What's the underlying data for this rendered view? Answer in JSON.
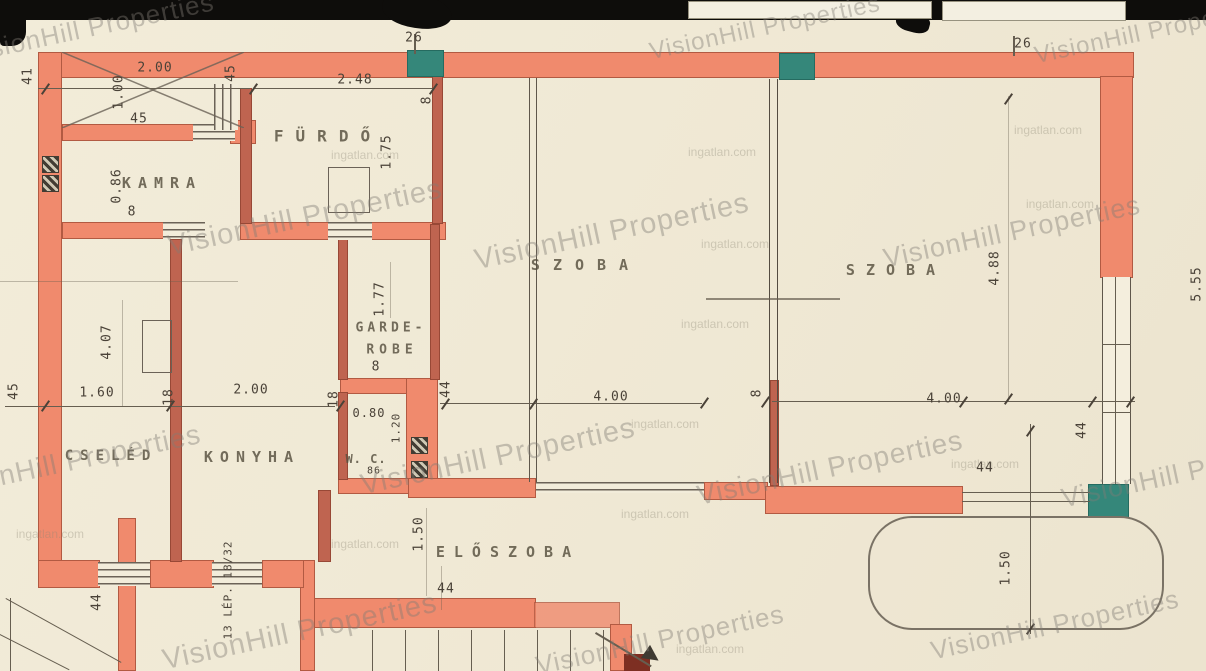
{
  "watermarks": {
    "brand_text": "VisionHill Properties",
    "site_text": "ingatlan.com",
    "brand_marks": [
      {
        "x": 90,
        "y": 28,
        "size": 26
      },
      {
        "x": 765,
        "y": 28,
        "size": 24
      },
      {
        "x": 1150,
        "y": 32,
        "size": 24
      },
      {
        "x": 305,
        "y": 218,
        "size": 29
      },
      {
        "x": 612,
        "y": 232,
        "size": 29
      },
      {
        "x": 1012,
        "y": 232,
        "size": 27
      },
      {
        "x": 68,
        "y": 462,
        "size": 28
      },
      {
        "x": 498,
        "y": 457,
        "size": 29
      },
      {
        "x": 830,
        "y": 468,
        "size": 28
      },
      {
        "x": 1190,
        "y": 472,
        "size": 27
      },
      {
        "x": 300,
        "y": 632,
        "size": 29
      },
      {
        "x": 660,
        "y": 640,
        "size": 26
      },
      {
        "x": 1055,
        "y": 625,
        "size": 26
      }
    ],
    "site_marks": [
      {
        "x": 722,
        "y": 152
      },
      {
        "x": 735,
        "y": 244
      },
      {
        "x": 715,
        "y": 324
      },
      {
        "x": 665,
        "y": 424
      },
      {
        "x": 655,
        "y": 514
      },
      {
        "x": 365,
        "y": 544
      },
      {
        "x": 50,
        "y": 534
      },
      {
        "x": 985,
        "y": 464
      },
      {
        "x": 1048,
        "y": 130
      },
      {
        "x": 1060,
        "y": 204
      },
      {
        "x": 710,
        "y": 649
      },
      {
        "x": 365,
        "y": 155
      }
    ]
  },
  "floorplan": {
    "room_labels": [
      {
        "text": "FÜRDŐ",
        "x": 328,
        "y": 136,
        "size": 16,
        "ls": 12
      },
      {
        "text": "KAMRA",
        "x": 162,
        "y": 183,
        "size": 15,
        "ls": 7
      },
      {
        "text": "SZOBA",
        "x": 586,
        "y": 265,
        "size": 15,
        "ls": 13
      },
      {
        "text": "SZOBA",
        "x": 896,
        "y": 270,
        "size": 15,
        "ls": 11
      },
      {
        "text": "GARDE-",
        "x": 391,
        "y": 328,
        "size": 13,
        "ls": 4
      },
      {
        "text": "ROBE",
        "x": 392,
        "y": 350,
        "size": 13,
        "ls": 5
      },
      {
        "text": "KONYHA",
        "x": 252,
        "y": 457,
        "size": 15,
        "ls": 7
      },
      {
        "text": "CSELÉD",
        "x": 111,
        "y": 456,
        "size": 14,
        "ls": 7
      },
      {
        "text": "W. C.",
        "x": 366,
        "y": 459,
        "size": 12,
        "ls": 1
      },
      {
        "text": "ELŐSZOBA",
        "x": 508,
        "y": 552,
        "size": 15,
        "ls": 9
      }
    ],
    "dimension_labels": [
      {
        "text": "41",
        "x": 28,
        "y": 76,
        "rot": -90
      },
      {
        "text": "2.00",
        "x": 155,
        "y": 68,
        "rot": 0
      },
      {
        "text": "1.00",
        "x": 119,
        "y": 92,
        "rot": -90
      },
      {
        "text": "45",
        "x": 139,
        "y": 119,
        "rot": 0
      },
      {
        "text": "45",
        "x": 231,
        "y": 73,
        "rot": -90
      },
      {
        "text": "2.48",
        "x": 355,
        "y": 80,
        "rot": 0
      },
      {
        "text": "26",
        "x": 414,
        "y": 38,
        "rot": 0
      },
      {
        "text": "8",
        "x": 427,
        "y": 100,
        "rot": -90
      },
      {
        "text": "1.75",
        "x": 387,
        "y": 152,
        "rot": -90
      },
      {
        "text": "0.86",
        "x": 117,
        "y": 186,
        "rot": -90
      },
      {
        "text": "8",
        "x": 132,
        "y": 212,
        "rot": 0
      },
      {
        "text": "1.77",
        "x": 380,
        "y": 299,
        "rot": -90
      },
      {
        "text": "8",
        "x": 376,
        "y": 367,
        "rot": 0
      },
      {
        "text": "26",
        "x": 1023,
        "y": 44,
        "rot": 0
      },
      {
        "text": "4.88",
        "x": 995,
        "y": 268,
        "rot": -90
      },
      {
        "text": "5.55",
        "x": 1197,
        "y": 284,
        "rot": -90
      },
      {
        "text": "4.07",
        "x": 107,
        "y": 342,
        "rot": -90
      },
      {
        "text": "45",
        "x": 14,
        "y": 391,
        "rot": -90
      },
      {
        "text": "1.60",
        "x": 97,
        "y": 393,
        "rot": 0
      },
      {
        "text": "18",
        "x": 169,
        "y": 397,
        "rot": -90
      },
      {
        "text": "2.00",
        "x": 251,
        "y": 390,
        "rot": 0
      },
      {
        "text": "18",
        "x": 334,
        "y": 399,
        "rot": -90
      },
      {
        "text": "0.80",
        "x": 369,
        "y": 413,
        "rot": 0,
        "size": 12
      },
      {
        "text": "1.20",
        "x": 396,
        "y": 428,
        "rot": -90,
        "size": 11
      },
      {
        "text": "44",
        "x": 446,
        "y": 389,
        "rot": -90
      },
      {
        "text": "4.00",
        "x": 611,
        "y": 397,
        "rot": 0
      },
      {
        "text": "8",
        "x": 757,
        "y": 393,
        "rot": -90
      },
      {
        "text": "4.00",
        "x": 944,
        "y": 399,
        "rot": 0
      },
      {
        "text": "44",
        "x": 1082,
        "y": 430,
        "rot": -90
      },
      {
        "text": "44",
        "x": 985,
        "y": 468,
        "rot": 0
      },
      {
        "text": "1.50",
        "x": 1006,
        "y": 568,
        "rot": -90
      },
      {
        "text": "1.50",
        "x": 419,
        "y": 534,
        "rot": -90
      },
      {
        "text": "44",
        "x": 446,
        "y": 589,
        "rot": 0
      },
      {
        "text": "44",
        "x": 97,
        "y": 602,
        "rot": -90
      },
      {
        "text": "86",
        "x": 374,
        "y": 471,
        "rot": 0,
        "size": 10
      }
    ],
    "stair_note": {
      "text": "13 LÉP. 18/32",
      "x": 228,
      "y": 590,
      "rot": -90,
      "size": 11
    }
  }
}
